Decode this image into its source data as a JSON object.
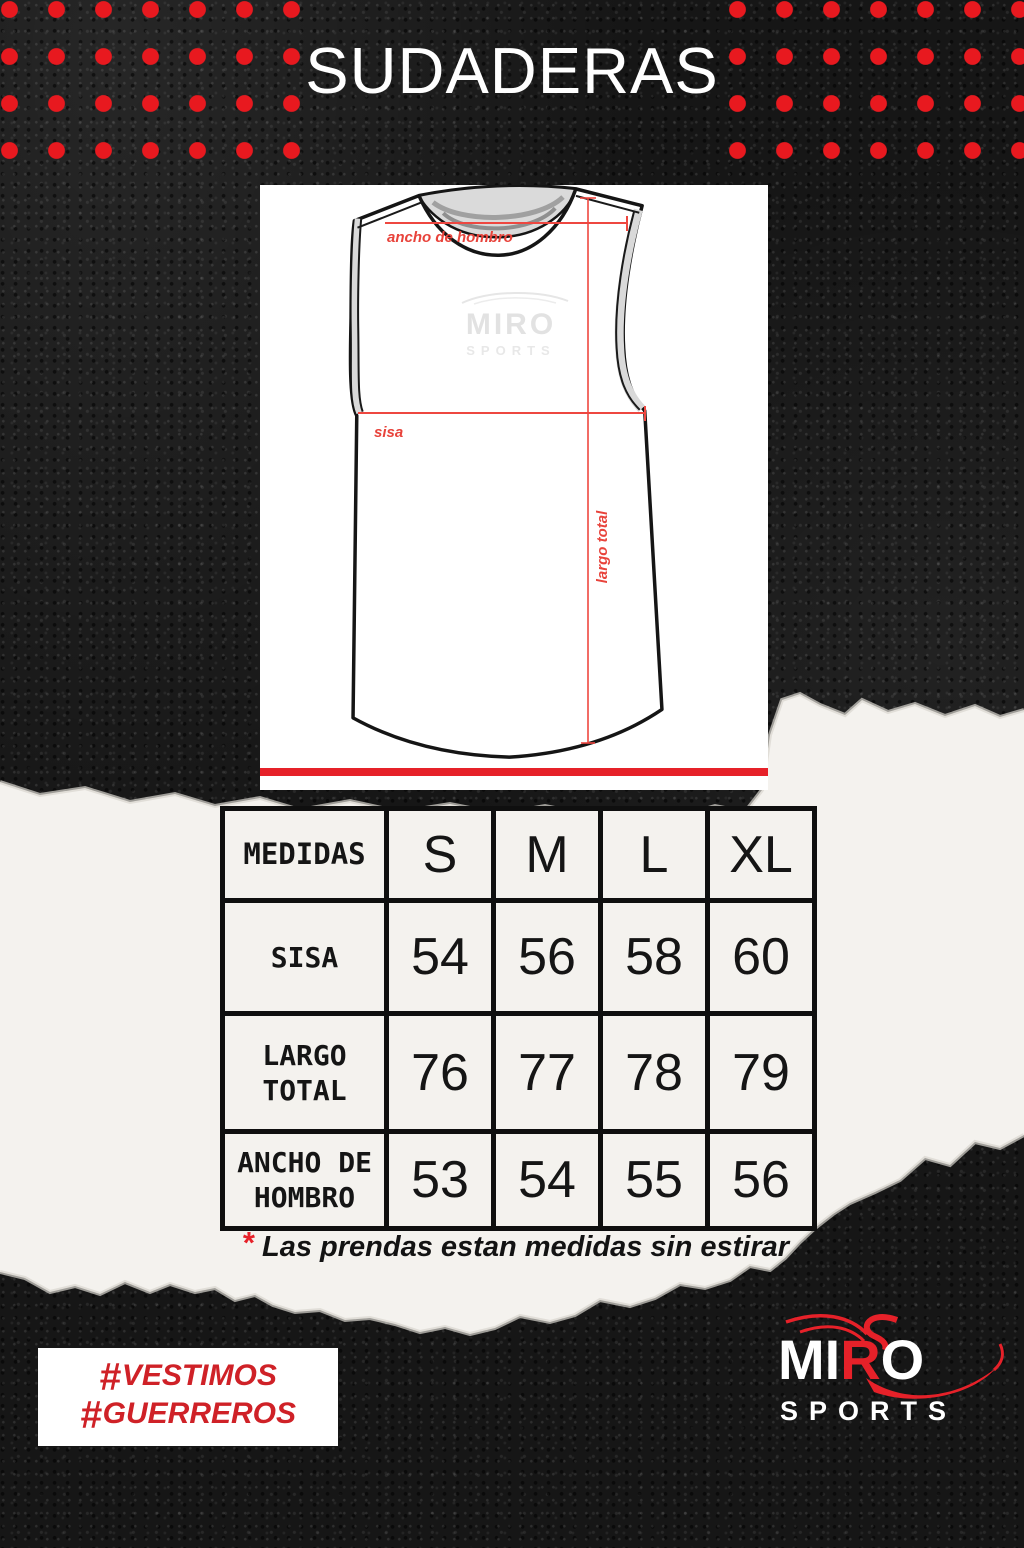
{
  "flyer": {
    "title": "SUDADERAS"
  },
  "diagram": {
    "dimension_labels": {
      "shoulder": "ancho de hombro",
      "chest": "sisa",
      "length": "largo total"
    },
    "watermark": {
      "brand": "MIRO",
      "sub": "SPORTS"
    }
  },
  "size_table": {
    "headers": [
      "MEDIDAS",
      "S",
      "M",
      "L",
      "XL"
    ],
    "rows": [
      {
        "label": "SISA",
        "values": [
          "54",
          "56",
          "58",
          "60"
        ]
      },
      {
        "label": "LARGO TOTAL",
        "values": [
          "76",
          "77",
          "78",
          "79"
        ]
      },
      {
        "label": "ANCHO DE HOMBRO",
        "values": [
          "53",
          "54",
          "55",
          "56"
        ]
      }
    ]
  },
  "note": {
    "marker": "*",
    "text": "Las prendas estan medidas sin estirar"
  },
  "footer": {
    "hashtags": [
      {
        "hash": "#",
        "word": "VESTIMOS"
      },
      {
        "hash": "#",
        "word": "GUERREROS"
      }
    ],
    "brand": {
      "mi": "MI",
      "r": "R",
      "o": "O",
      "sub": "SPORTS"
    }
  },
  "colors": {
    "dot_red": "#e8191f",
    "accent_red": "#e62129",
    "dim_red": "#ee4740",
    "hashtag_red": "#cf2127",
    "paper": "#f4f2ee",
    "panel": "#ffffff",
    "ink": "#141414"
  }
}
